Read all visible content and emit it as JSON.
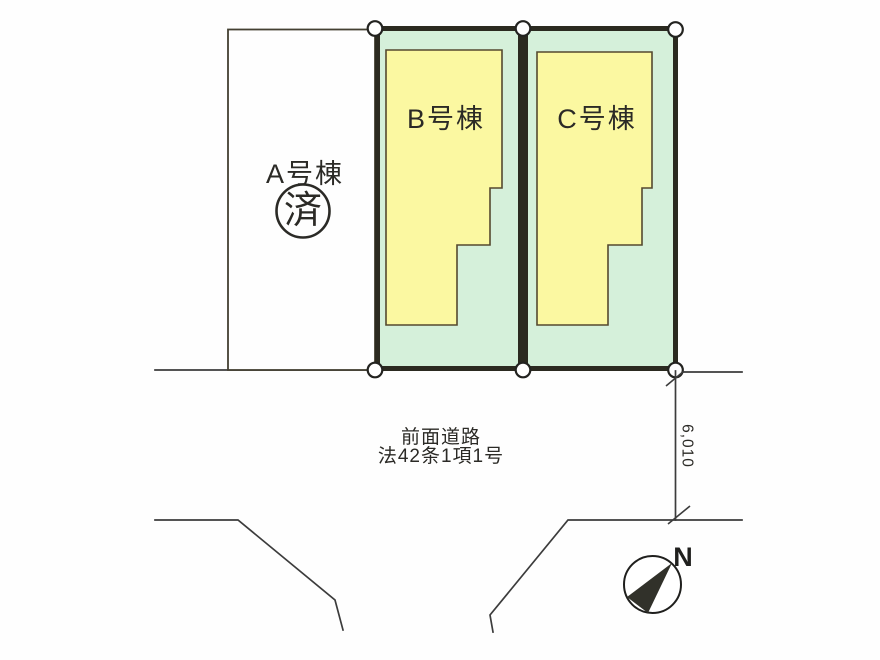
{
  "colors": {
    "parcel_fill": "#d5f0da",
    "building_fill": "#fbf8a1",
    "parcel_border": "#2b2a20",
    "building_border": "#55492f",
    "lot_a_border": "#444032",
    "lot_a_fill": "#fefefe",
    "drawing_line": "#3c3c3c",
    "text": "#2b2a26",
    "marker_fill": "#ffffff",
    "marker_border": "#232320",
    "needle_fill": "#31312a",
    "compass_ring": "#1f1f1d"
  },
  "lots": [
    {
      "id": "A",
      "label": "A号棟",
      "status": "済"
    },
    {
      "id": "B",
      "label": "B号棟"
    },
    {
      "id": "C",
      "label": "C号棟"
    }
  ],
  "road": {
    "name": "前面道路",
    "law": "法42条1項1号"
  },
  "dimension": {
    "road_width": "6,010"
  },
  "compass": {
    "label": "N"
  }
}
